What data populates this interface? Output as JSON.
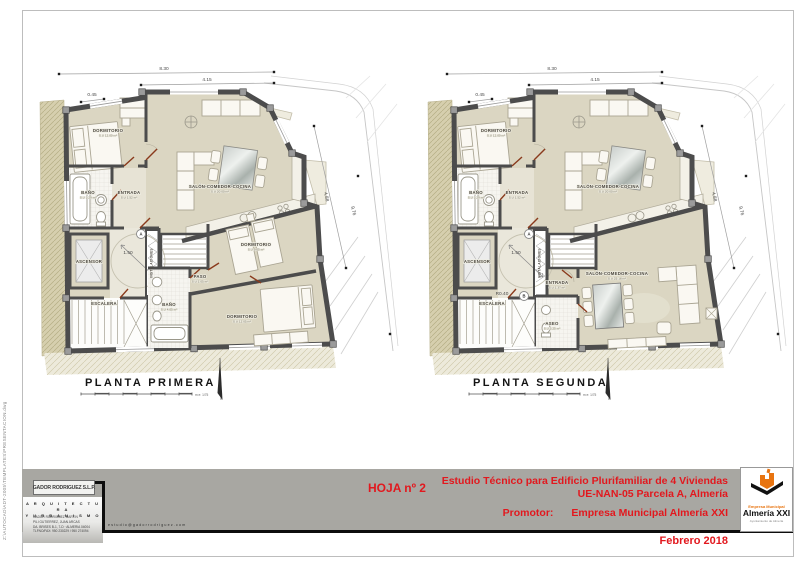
{
  "sheet": {
    "file_path": "Z:\\AUTOCAD\\ADT-2005\\TEMPLATES\\PRESENTACION.dwg"
  },
  "plans": [
    {
      "title": "PLANTA PRIMERA",
      "scale_note": "m   e: 1/75",
      "rooms": [
        {
          "t": "DORMITORIO",
          "s": "S.U 12.00 m²",
          "x": 84,
          "y": 76
        },
        {
          "t": "BAÑO",
          "s": "S.U 3.29 m²",
          "x": 64,
          "y": 138
        },
        {
          "t": "ENTRADA",
          "s": "S.U 1.52 m²",
          "x": 105,
          "y": 138
        },
        {
          "t": "SALÓN-COMEDOR-COCINA",
          "s": "S.U 20.00 m²",
          "x": 196,
          "y": 132
        },
        {
          "t": "ASCENSOR",
          "x": 65,
          "y": 207
        },
        {
          "t": "INSTALACIONES",
          "x": 128.5,
          "y": 207,
          "r": -90,
          "c": "rsmall"
        },
        {
          "t": "ESCALERA",
          "x": 80,
          "y": 249
        },
        {
          "t": "PASO",
          "s": "S.U 1.05 m²",
          "x": 176,
          "y": 222
        },
        {
          "t": "BAÑO",
          "s": "S.U 4.05 m²",
          "x": 145,
          "y": 250
        },
        {
          "t": "DORMITORIO",
          "s": "S.U 9.05 m²",
          "x": 232,
          "y": 190
        },
        {
          "t": "DORMITORIO",
          "s": "S.U 12.05 m²",
          "x": 218,
          "y": 262
        }
      ],
      "dims": [
        {
          "t": "8.30",
          "x": 140,
          "y": 14
        },
        {
          "t": "4.15",
          "x": 183,
          "y": 25
        },
        {
          "t": "0.45",
          "x": 68,
          "y": 40
        },
        {
          "t": "4.88",
          "x": 301,
          "y": 141,
          "r": 77
        },
        {
          "t": "9.76",
          "x": 328,
          "y": 155,
          "r": 77
        },
        {
          "t": "1.50",
          "x": 104,
          "y": 198
        }
      ],
      "nodes": [
        {
          "t": "A",
          "x": 117,
          "y": 178
        }
      ]
    },
    {
      "title": "PLANTA SEGUNDA",
      "scale_note": "m   e: 1/75",
      "rooms": [
        {
          "t": "DORMITORIO",
          "s": "S.U 12.00 m²",
          "x": 84,
          "y": 76
        },
        {
          "t": "BAÑO",
          "s": "S.U 3.29 m²",
          "x": 64,
          "y": 138
        },
        {
          "t": "ENTRADA",
          "s": "S.U 1.52 m²",
          "x": 105,
          "y": 138
        },
        {
          "t": "SALÓN-COMEDOR-COCINA",
          "s": "S.U 20.00 m²",
          "x": 196,
          "y": 132
        },
        {
          "t": "ASCENSOR",
          "x": 65,
          "y": 207
        },
        {
          "t": "INSTALACIONES",
          "x": 128.5,
          "y": 207,
          "r": -90,
          "c": "rsmall"
        },
        {
          "t": "ESCALERA",
          "x": 80,
          "y": 249
        },
        {
          "t": "SALÓN-COMEDOR-COCINA",
          "s": "S.U 25.18 m²",
          "x": 205,
          "y": 219
        },
        {
          "t": "ENTRADA",
          "s": "S.U 1.37 m²",
          "x": 145,
          "y": 228
        },
        {
          "t": "ASEO",
          "s": "S.U 3.25 m²",
          "x": 140,
          "y": 269
        }
      ],
      "dims": [
        {
          "t": "8.30",
          "x": 140,
          "y": 14
        },
        {
          "t": "4.15",
          "x": 183,
          "y": 25
        },
        {
          "t": "0.45",
          "x": 68,
          "y": 40
        },
        {
          "t": "4.88",
          "x": 301,
          "y": 141,
          "r": 77
        },
        {
          "t": "9.76",
          "x": 328,
          "y": 155,
          "r": 77
        },
        {
          "t": "1.50",
          "x": 104,
          "y": 198
        },
        {
          "t": "R0.40",
          "x": 90,
          "y": 239
        }
      ],
      "nodes": [
        {
          "t": "A",
          "x": 117,
          "y": 178
        },
        {
          "t": "B",
          "x": 112,
          "y": 240
        }
      ]
    }
  ],
  "titleblock": {
    "firm_name": "GADOR RODRIGUEZ S.L.P.",
    "firm_line1": "A R Q U I T E C T U R A",
    "firm_line2": "Y   U R B A N I S M O",
    "firm_details": [
      "GADOR RODRIGUEZ MARTIN",
      "PILI GUTIERREZ, JUAN ARCAS",
      "DA. BRISES B-1, 7-D · ALMERIA 04004",
      "TLFNO/FAX: 950 230229 / 950 274094"
    ],
    "email": "estudio@gadorrodriguez.com",
    "sheet_no": "HOJA nº 2",
    "project_line1": "Estudio Técnico para Edificio Plurifamiliar de 4 Viviendas",
    "project_line2": "UE-NAN-05 Parcela A, Almería",
    "promoter_label": "Promotor:",
    "promoter_value": "Empresa Municipal Almería XXI",
    "date": "Febrero 2018",
    "logo_line1": "Empresa Municipal",
    "logo_line2": "Almería XXI",
    "logo_line3": "Ayuntamiento de Almería"
  }
}
